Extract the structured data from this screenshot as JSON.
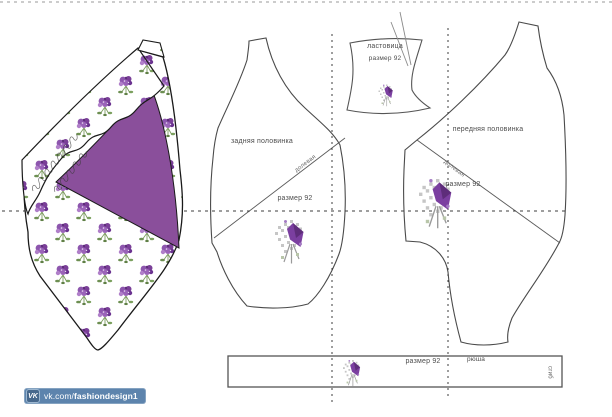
{
  "pattern": {
    "gusset": {
      "name": "ластовица",
      "size": "размер 92"
    },
    "back": {
      "name": "задняя половинка",
      "size": "размер 92",
      "grain": "долевая"
    },
    "front": {
      "name": "передняя половинка",
      "size": "размер 92",
      "grain": "долевая"
    },
    "strip": {
      "name": "рюша",
      "size": "размер 92",
      "fold": "сгиб"
    }
  },
  "watermark": {
    "vk": "VK",
    "url_prefix": "vk.com/",
    "url_bold": "fashiondesign1"
  },
  "colors": {
    "accent_purple": "#8a4f9b",
    "flower_purple": "#7a3f98",
    "leaf_green": "#6d8f52",
    "outline": "#4a4a4a",
    "vk_blue": "#5d84ad"
  }
}
